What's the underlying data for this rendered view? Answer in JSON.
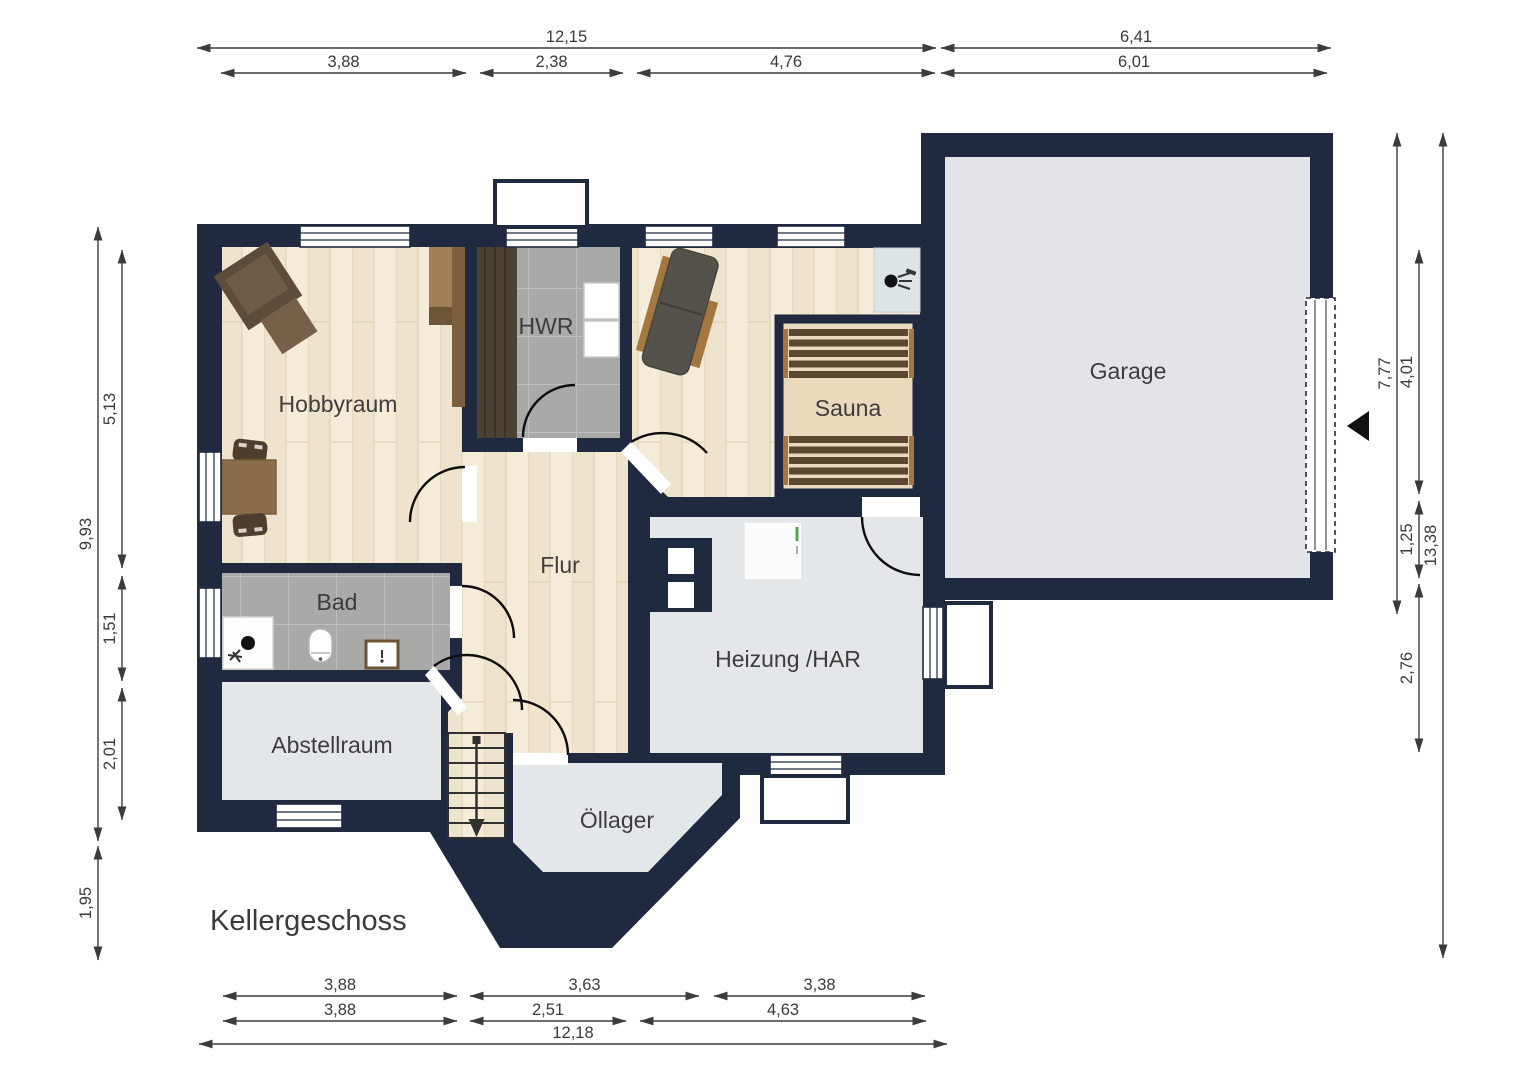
{
  "title": "Kellergeschoss",
  "rooms": {
    "hobbyraum": "Hobbyraum",
    "hwr": "HWR",
    "sauna": "Sauna",
    "garage": "Garage",
    "bad": "Bad",
    "flur": "Flur",
    "heizung": "Heizung /HAR",
    "abstellraum": "Abstellraum",
    "oellager": "Öllager"
  },
  "dimensions": {
    "top_row1": [
      "12,15",
      "6,41"
    ],
    "top_row2": [
      "3,88",
      "2,38",
      "4,76",
      "6,01"
    ],
    "bottom_row1": [
      "3,88",
      "3,63",
      "3,38"
    ],
    "bottom_row2": [
      "3,88",
      "2,51",
      "4,63"
    ],
    "bottom_row3": [
      "12,18"
    ],
    "left_outer": [
      "9,93",
      "1,95"
    ],
    "left_inner": [
      "5,13",
      "1,51",
      "2,01"
    ],
    "right_inner": [
      "7,77"
    ],
    "right_mid": [
      "4,01",
      "1,25",
      "2,76"
    ],
    "right_outer": [
      "13,38"
    ]
  },
  "icons": {
    "stairs_direction": "down-arrow",
    "entrance": "left-triangle",
    "shower": "shower-head-dot",
    "toilet": "toilet-oval",
    "washbasin": "framed-basin"
  },
  "colors": {
    "wall": "#1f2a40",
    "wood_floor": "#eee3cd",
    "tile_floor": "#a9a9a7",
    "plain_floor": "#e4e7ea",
    "sauna_bench": "#5c4731",
    "label_text": "#3d3d3d",
    "dimension_text": "#3a3a3a"
  }
}
